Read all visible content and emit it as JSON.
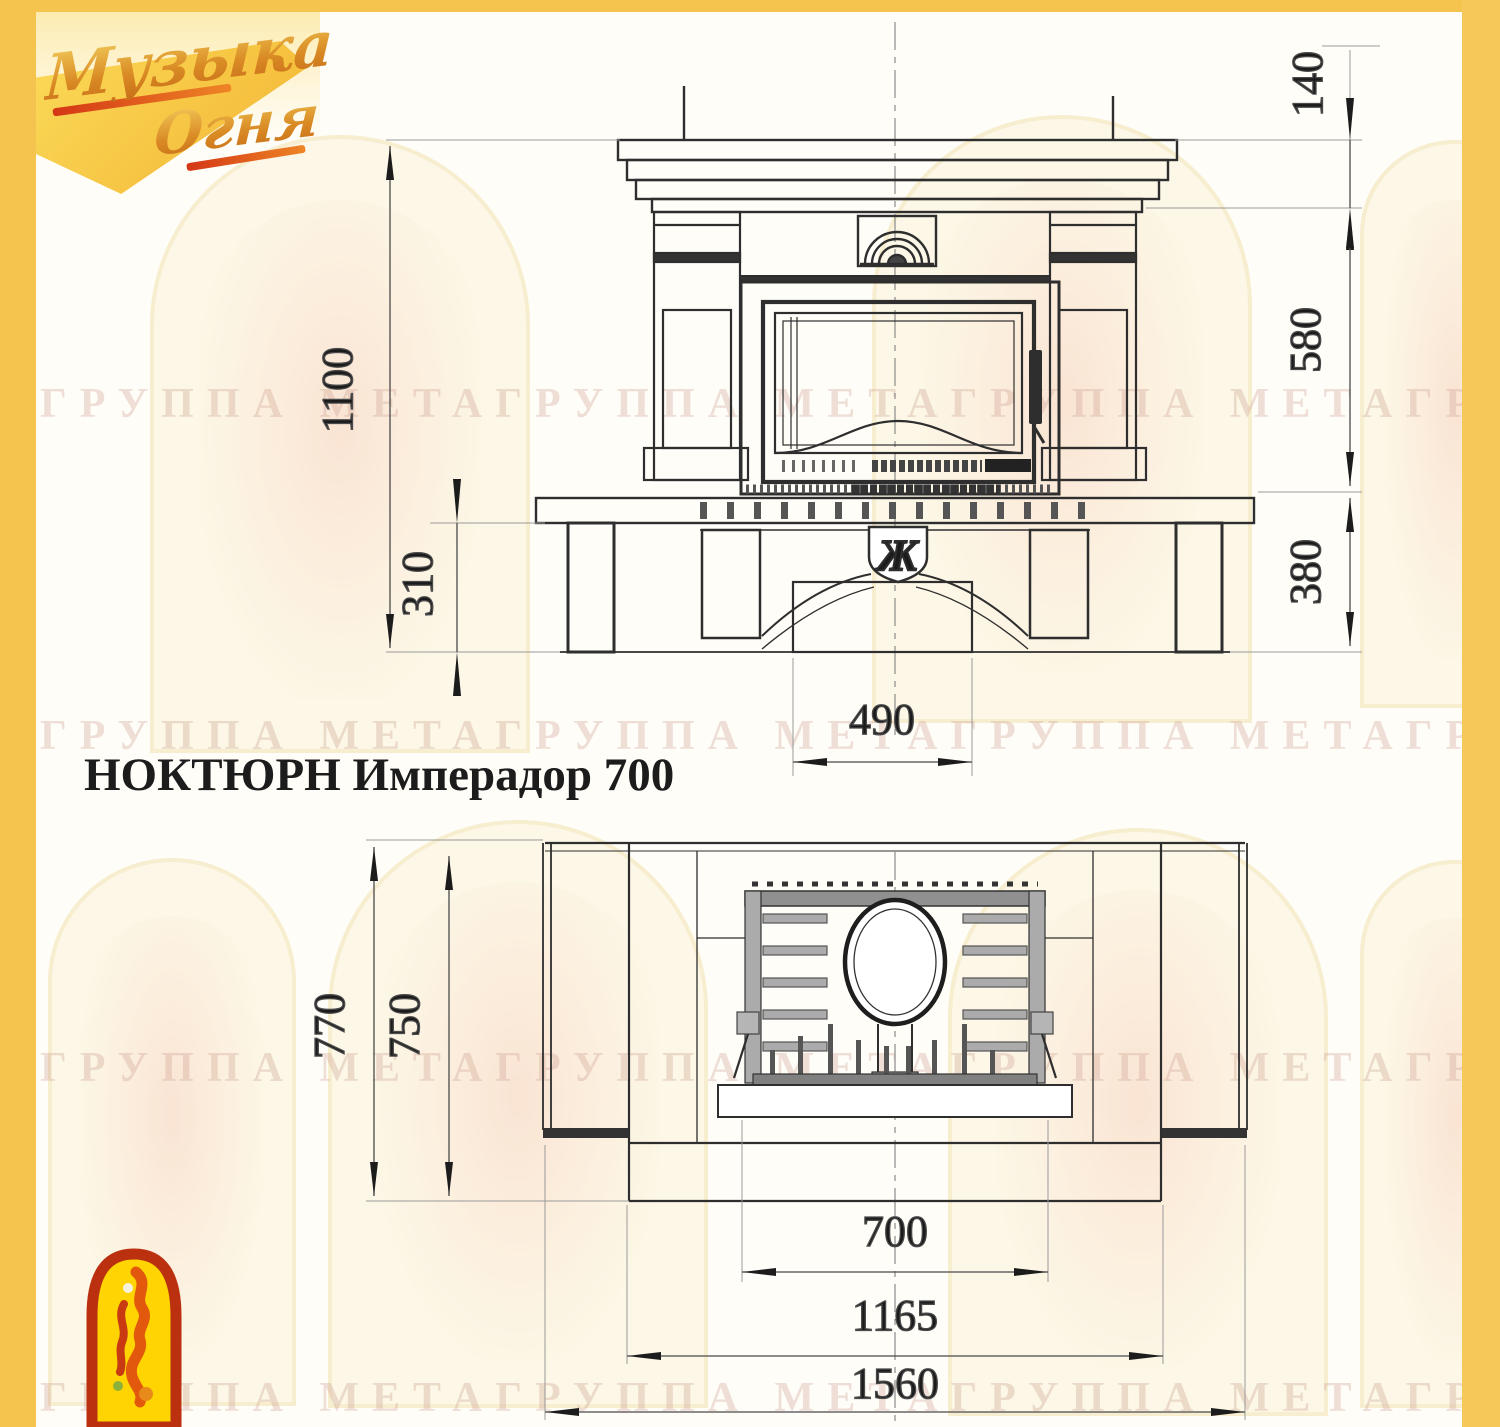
{
  "page": {
    "accent_yellow": "#F4C44F",
    "background": "#FFFDF8"
  },
  "logo": {
    "line1": "Музыка",
    "line2": "Огня"
  },
  "title": "НОКТЮРН Имперадор 700",
  "watermark": {
    "text": "ГРУППА МЕТАГРУППА МЕТАГРУППА МЕТАГРУППА МЕТА"
  },
  "front_view": {
    "emblem_letter": "Ж",
    "dims": {
      "height_total": "1100",
      "plinth_height": "310",
      "pedestal_width": "490",
      "crown_height": "140",
      "firebox_height": "580",
      "base_height": "380"
    }
  },
  "plan_view": {
    "dims": {
      "depth_total": "770",
      "depth_body": "750",
      "opening_width": "700",
      "body_width": "1165",
      "width_total": "1560"
    }
  }
}
